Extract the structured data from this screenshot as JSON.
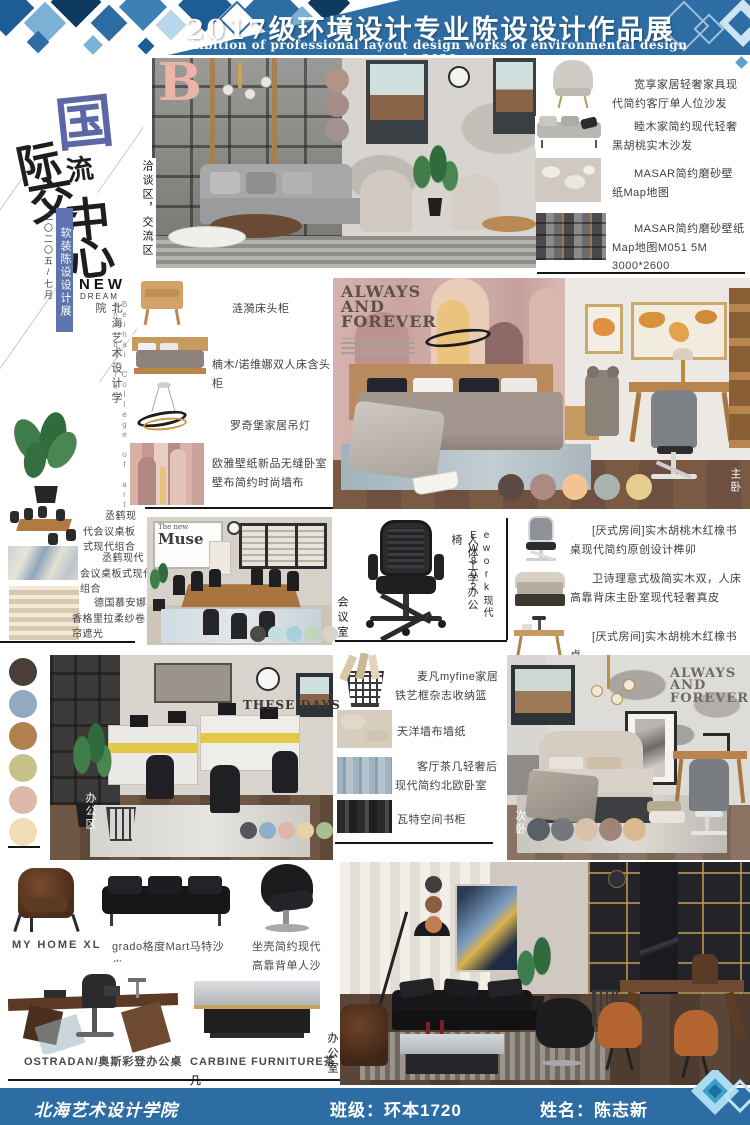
{
  "colors": {
    "band_blue": "#2e6da3",
    "ribbon_blue": "#5f74ae",
    "calligraphy_blue": "#5c68a6",
    "letter_pink": "#eab5a8"
  },
  "header": {
    "title": "2017级环境设计专业陈设设计作品展",
    "subtitle": "Exhibition of professional layout design works of environmental design in 2020"
  },
  "hero": {
    "chars": [
      "国",
      "际",
      "交",
      "流",
      "中",
      "心"
    ],
    "date_note": "二〇二〇五/七月",
    "ribbon": "软装陈设设计展",
    "new_label": "NEW",
    "dream_label": "DREAM",
    "school_cn": "北海艺术设计学院",
    "school_en": "Beihai College of art and design",
    "letter": "B"
  },
  "areas": {
    "lounge": "洽谈区，交流区",
    "master": "主卧",
    "meeting": "会议室",
    "office_zone": "办公区",
    "second": "次卧",
    "office_room": "办公室"
  },
  "posters": {
    "always": "ALWAYS AND FOREVER",
    "these_days": "THESE DAYS",
    "muse_small": "The new",
    "muse_big": "Muse"
  },
  "right_products": [
    {
      "label": "宽享家居轻奢家具现代简约客厅单人位沙发"
    },
    {
      "label": "睦木家简约现代轻奢黑胡桃实木沙发"
    },
    {
      "label": "MASAR简约磨砂壁纸Map地图"
    },
    {
      "label": "MASAR简约磨砂壁纸Map地图M051 5M 3000*2600"
    }
  ],
  "bedroom_products": [
    {
      "label": "涟漪床头柜"
    },
    {
      "label": "楠木/诺维娜双人床含头柜"
    },
    {
      "label": "罗奇堡家居吊灯"
    },
    {
      "label": "欧雅壁纸新品无缝卧室壁布简约时尚墙布"
    }
  ],
  "meeting_products": [
    {
      "label": "丞鹤现代会议桌板式现代组合"
    },
    {
      "label": "丞鹤现代会议桌板式现代组合"
    },
    {
      "label": "德国慕安娜香格里拉柔纱卷帘遮光"
    }
  ],
  "chair_panel": {
    "model": "ework现代EW802",
    "type": "人体工学办公椅"
  },
  "study_products": [
    {
      "label": "[厌式房间]实木胡桃木红橡书桌现代简约原创设计榫卯"
    },
    {
      "label": "卫诗理意式极简实木双，人床高靠背床主卧室现代轻奢真皮"
    },
    {
      "label": "[厌式房间]实木胡桃木红橡书桌"
    }
  ],
  "decor_products": [
    {
      "label": "麦凡myfine家居铁艺框杂志收纳篮"
    },
    {
      "label": "天洋墙布墙纸"
    },
    {
      "label": "客厅茶几轻奢后现代简约北欧卧室"
    },
    {
      "label": "瓦特空间书柜"
    }
  ],
  "bottom_products": [
    {
      "label": "MY HOME XL"
    },
    {
      "label": "grado格度Mart马特沙发"
    },
    {
      "label": "坐壳简约现代高靠背单人沙发"
    },
    {
      "label": "OSTRADAN/奥斯彩登办公桌"
    },
    {
      "label": "CARBINE FURNITURE茶几"
    }
  ],
  "palettes": {
    "living": [
      "#b29486",
      "#a68d88",
      "#a39390"
    ],
    "master": [
      "#5c4a46",
      "#aa8a82",
      "#f2c493",
      "#a9b4b0",
      "#e6cc8e"
    ],
    "meeting": [
      "#4a4a46",
      "#c6dedb",
      "#a8cfe0",
      "#c2d4bc",
      "#d8d5c6"
    ],
    "office_strip": [
      "#4a3e36",
      "#92aabf",
      "#b28052",
      "#c9c288",
      "#dfb8a9",
      "#efddb6"
    ],
    "office_inner": [
      "#55565a",
      "#8fb0c8",
      "#ddb6a8",
      "#e6d3a8",
      "#a8bf8f"
    ],
    "second": [
      "#5b6068",
      "#74777e",
      "#d8c2ac",
      "#9e8578",
      "#d9b98f"
    ],
    "exec": [
      "#3f3f41",
      "#8a5f3f",
      "#c07e52"
    ]
  },
  "footer": {
    "school": "北海艺术设计学院",
    "class_field": "班级：环本1720",
    "name_field": "姓名：陈志新"
  }
}
